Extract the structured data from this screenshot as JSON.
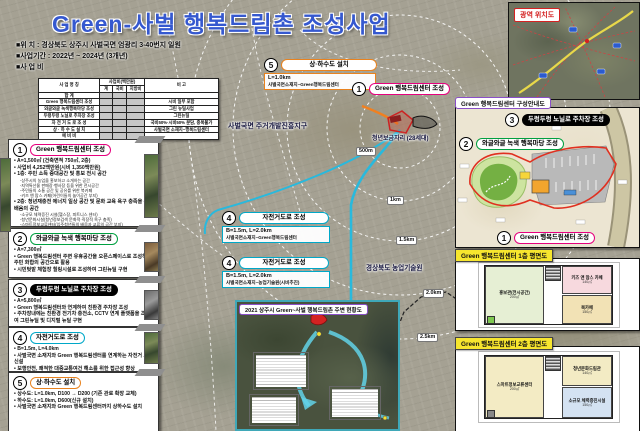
{
  "title": "Green-사벌 행복드림촌 조성사업",
  "meta": {
    "location": "■위    치 : 경상북도 상주시 사벌국면 엄광리 3-40번지 일원",
    "period": "■사업기간 : 2022년 ~ 2024년 (3개년)",
    "budget": "■사 업 비"
  },
  "budget_table": {
    "h_name": "사 업 명 칭",
    "h_cost": "사업비(백만원)",
    "h_sub": [
      "계",
      "국비",
      "지방비"
    ],
    "h_note": "비  고",
    "rows": [
      {
        "name": "합              계",
        "note": ""
      },
      {
        "name": "Green 행복드림센터 조성",
        "note": "시비 일부 포함"
      },
      {
        "name": "와글와글 녹색행복마당 조성",
        "note": "그린 뉴딜사업"
      },
      {
        "name": "두렁두렁 노닐로 주차장 조성",
        "note": "그린뉴딜"
      },
      {
        "name": "자 전 거 도 로  조 성",
        "note": "국비50%·시비50% 분담, 중복불가"
      },
      {
        "name": "상 · 하 수 도  설 치",
        "note": "사벌국면 소재지~행복드림센터"
      },
      {
        "name": "예       비       비",
        "note": ""
      }
    ]
  },
  "cards": [
    {
      "num": "1",
      "title": "Green 행복드림센터 조성",
      "bullets": [
        "A=1,500㎡ (건축면적 750㎡, 2층)",
        "사업비 4,252백만원(시비 1,350백만원)",
        "1층: 주민 소득 증대공간 및 홍보 전시 공간"
      ],
      "sub1": [
        "-상주시의 농업을 홍보하고 소개하는 공간",
        "-지역특산물 판매장·행사장 등을 위한 전시공간",
        "-주민들의 소통 공간 및 공유를 위한 북카페",
        "-키즈 앤 맘스 카페(어린이들의 놀이공간 부지)"
      ],
      "bullet2": "2층: 청년재충전 에너지 일상 공간 및 문화 교육 욕구 충족을 위한 배움의 공간",
      "sub2": [
        "-소규모 체력증진 시설(헬스장, 피트니스 센터)",
        "-청년문화시설(청년정보검색 문화적·직장적 욕구 충족)",
        "-스마트정보교류센터(입주청년들의 배움과 교류의 공간 부지)"
      ]
    },
    {
      "num": "2",
      "title": "와글와글 녹색 행복마당 조성",
      "bullets": [
        "A=7,300㎡",
        "Green 행복드림센터 주변 유휴공간을 오픈스페이스로 조성하여 주민 화합의 공간으로 활용",
        "시민텃밭 체험장 힐링시설로 조성하여 그린뉴딜 구현"
      ]
    },
    {
      "num": "3",
      "title": "두렁두렁 노닐로 주차장 조성",
      "bullets": [
        "A=5,800㎡",
        "Green 행복드림센터와 연계하여 친환경 주차장 조성",
        "주차장내에는 친환경 전기차 충전소, CCTV 연계 플랫폼을 조성하여 그린뉴딜 및 디지털 뉴딜 구현"
      ]
    },
    {
      "num": "4",
      "title": "자전거도로 조성",
      "bullets": [
        "B=1.5m, L=4.0km",
        "사벌국면 소재지와 Green 행복드림센터를 연계하는 자전거 도로 신설",
        "보행안전, 쾌적한 대중교통여건 해소를 위한 접근성 향상"
      ]
    },
    {
      "num": "5",
      "title": "상·하수도 설치",
      "bullets": [
        "상수도: L=1.0km, D100 → D200 (기존 관로 확장 교체)",
        "하수도: L=1.0km, D600(신규 설치)",
        "사벌국면 소재지와 Green 행복드림센터까지 상하수도 설치"
      ]
    }
  ],
  "map": {
    "callout5": {
      "num": "5",
      "title": "상·하수도 설치",
      "line1": "L=1.0km",
      "line2": "사벌국면소재지~Green행복드림센터"
    },
    "callout1": {
      "num": "1",
      "title": "Green 행복드림센터 조성"
    },
    "district": "사벌국면 주거개발진흥지구",
    "youth": "청년보금자리 (28세대)",
    "agritech": "경상북도 농업기술원",
    "rings": [
      "500m",
      "1km",
      "1.5km",
      "2.0km",
      "2.5km"
    ],
    "callout4a": {
      "num": "4",
      "title": "자전거도로 조성",
      "line1": "B=1.5m, L=2.0km",
      "line2": "사벌국면소재지~Green행복드림센터"
    },
    "callout4b": {
      "num": "4",
      "title": "자전거도로 조성",
      "line1": "B=1.5m, L=2.0km",
      "line2": "사벌국면소재지~농업기술원(시비추진)"
    },
    "inset_title": "2021 상주시 Green~사벌 행복드림촌 주변 현황도"
  },
  "right": {
    "regional_title": "광역 위치도",
    "plan_title": "Green 행복드림센터 구성안내도",
    "plan_c3": {
      "num": "3",
      "title": "두렁두렁 노닐로 주차장 조성"
    },
    "plan_c2": {
      "num": "2",
      "title": "와글와글 녹색 행복마당 조성"
    },
    "plan_c1": {
      "num": "1",
      "title": "Green 행복드림센터 조성"
    },
    "floor1_title": "Green 행복드림센터 1층 평면도",
    "floor1_rooms": [
      {
        "name": "홍보관(전시공간)",
        "area": "200㎡"
      },
      {
        "name": "키즈 앤 맘스 카페",
        "area": "140㎡"
      },
      {
        "name": "북카페",
        "area": "150㎡"
      }
    ],
    "floor2_title": "Green 행복드림센터 2층 평면도",
    "floor2_rooms": [
      {
        "name": "스마트정보교류센터",
        "area": "200㎡"
      },
      {
        "name": "청년문화드림관",
        "area": "140㎡"
      },
      {
        "name": "소규모 체력증진시설",
        "area": "150㎡"
      }
    ]
  },
  "colors": {
    "accent1": "#e6007e",
    "accent2": "#00a040",
    "accent3": "#000000",
    "accent4": "#00a8c8",
    "accent5": "#e8821e",
    "title_blue": "#3558cf",
    "route_cyan": "#29b9dd"
  }
}
